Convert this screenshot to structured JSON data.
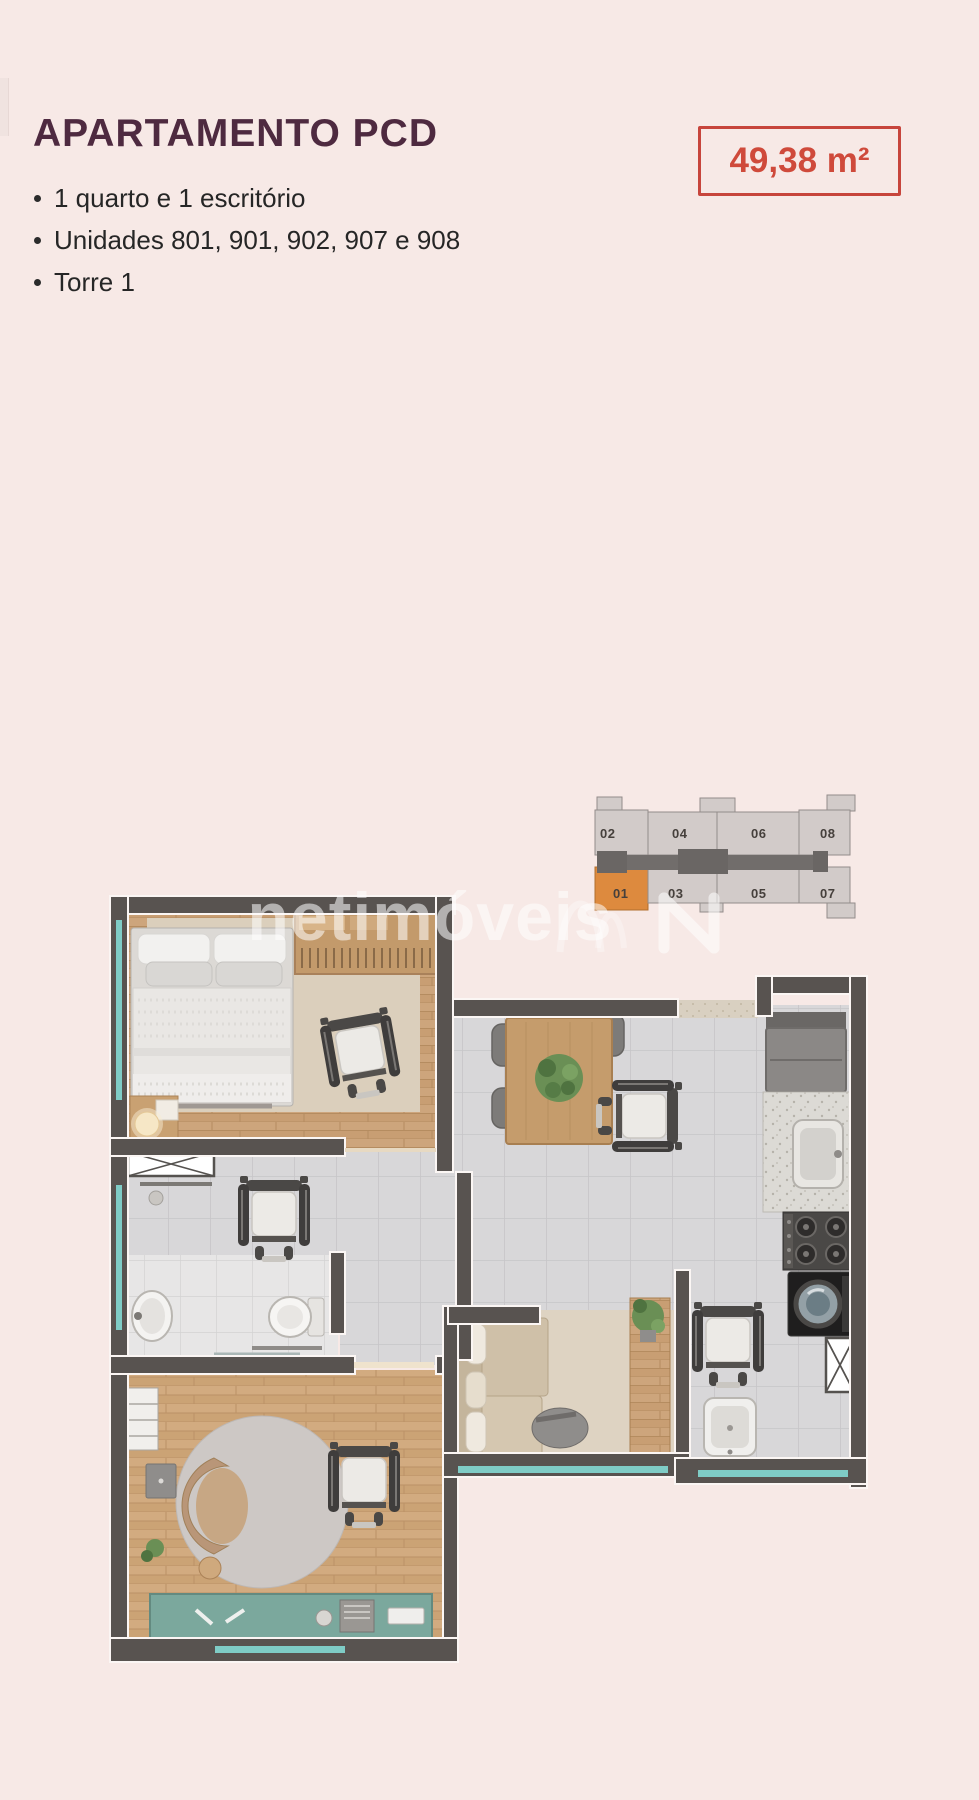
{
  "header": {
    "title": "APARTAMENTO PCD",
    "area_badge": "49,38 m²",
    "bullets": [
      "1 quarto e 1 escritório",
      "Unidades 801, 901, 902, 907 e 908",
      "Torre 1"
    ]
  },
  "key_plan": {
    "top_row": [
      "02",
      "04",
      "06",
      "08"
    ],
    "bottom_row": [
      "01",
      "03",
      "05",
      "07"
    ],
    "highlighted_unit": "01",
    "highlight_color": "#dd8a3e",
    "cell_color": "#d2cbc9",
    "corridor_color": "#716d6b"
  },
  "watermark": {
    "text": "netimóveis"
  },
  "colors": {
    "background": "#f7e9e6",
    "title": "#4e2a40",
    "badge_red": "#cf4a3b",
    "wall": "#585350",
    "tile_floor": "#d8d7d9",
    "wood_floor": "#cda57c",
    "window_teal": "#7fccc6",
    "desk_teal": "#7ba89d"
  }
}
